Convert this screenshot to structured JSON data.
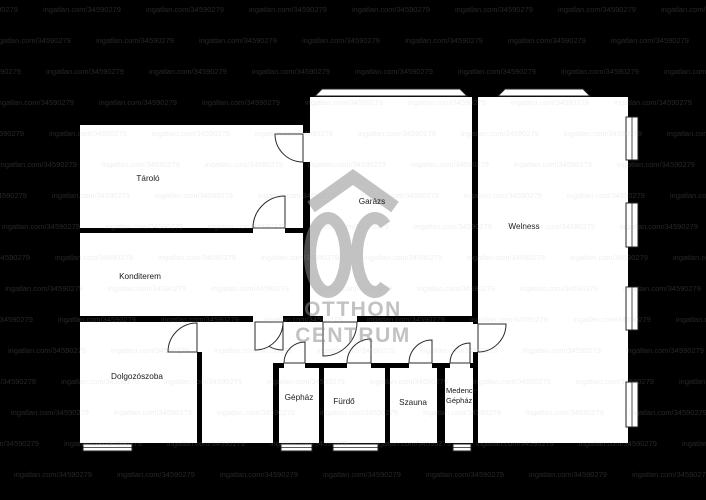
{
  "plan": {
    "rooms": [
      {
        "id": "tarolo",
        "label": "Tároló"
      },
      {
        "id": "konditerem",
        "label": "Konditerem"
      },
      {
        "id": "dolgozoszoba",
        "label": "Dolgozószoba"
      },
      {
        "id": "garazs",
        "label": "Garázs"
      },
      {
        "id": "welness",
        "label": "Welness"
      },
      {
        "id": "gephaz",
        "label": "Gépház"
      },
      {
        "id": "furdo",
        "label": "Fürdő"
      },
      {
        "id": "szauna",
        "label": "Szauna"
      },
      {
        "id": "medence_gephaz",
        "label": "Medence Gépház",
        "label_line1": "Medence",
        "label_line2": "Gépház"
      }
    ],
    "logo": {
      "monogram": "OC",
      "line1": "OTTHON",
      "line2": "CENTRUM"
    },
    "watermark": {
      "text": "ingatlan.com/34590279"
    },
    "colors": {
      "background": "#000000",
      "room_fill": "#ffffff",
      "wall": "#000000",
      "label": "#1a1a1a",
      "logo_gray": "#8c8c8c",
      "watermark_gray": "#b4b4b4"
    }
  }
}
